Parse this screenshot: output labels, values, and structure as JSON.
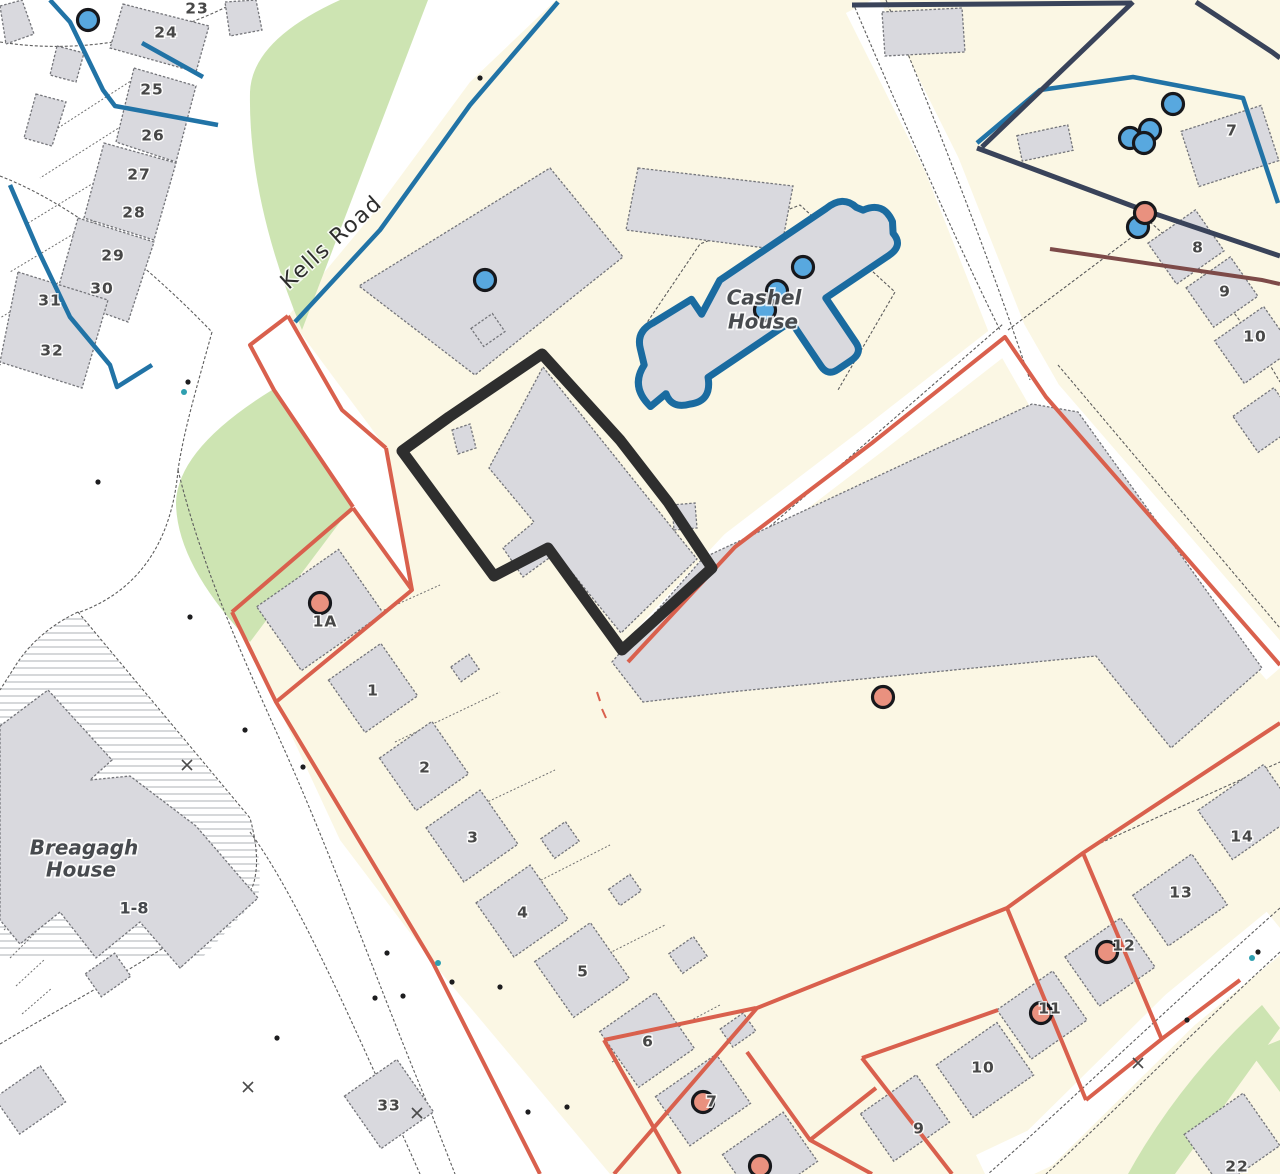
{
  "colors": {
    "plot_cream": "#fbf7e4",
    "building_gray": "#d9d9de",
    "green_area": "#cde4b2",
    "boundary_red": "#d9604d",
    "boundary_blue": "#2173a6",
    "boundary_navy": "#39435a",
    "cashel_blue": "#1a6ba0",
    "subject_outline": "#2e2e2e",
    "marker_blue": "#58a8df",
    "marker_orange": "#e9917f"
  },
  "road": {
    "name": "Kells Road"
  },
  "places": {
    "cashel_line1": "Cashel",
    "cashel_line2": "House",
    "breagagh_line1": "Breagagh",
    "breagagh_line2": "House",
    "breagagh_units": "1-8"
  },
  "plot_numbers": [
    {
      "t": "23",
      "x": 197,
      "y": 9
    },
    {
      "t": "24",
      "x": 166,
      "y": 33
    },
    {
      "t": "25",
      "x": 152,
      "y": 90
    },
    {
      "t": "26",
      "x": 153,
      "y": 136
    },
    {
      "t": "27",
      "x": 139,
      "y": 175
    },
    {
      "t": "28",
      "x": 134,
      "y": 213
    },
    {
      "t": "29",
      "x": 113,
      "y": 256
    },
    {
      "t": "30",
      "x": 102,
      "y": 289
    },
    {
      "t": "31",
      "x": 50,
      "y": 301
    },
    {
      "t": "32",
      "x": 52,
      "y": 351
    },
    {
      "t": "1A",
      "x": 325,
      "y": 622
    },
    {
      "t": "1",
      "x": 373,
      "y": 691
    },
    {
      "t": "2",
      "x": 425,
      "y": 768
    },
    {
      "t": "3",
      "x": 473,
      "y": 838
    },
    {
      "t": "4",
      "x": 523,
      "y": 913
    },
    {
      "t": "5",
      "x": 583,
      "y": 972
    },
    {
      "t": "6",
      "x": 648,
      "y": 1042
    },
    {
      "t": "7",
      "x": 712,
      "y": 1102
    },
    {
      "t": "33",
      "x": 389,
      "y": 1106
    },
    {
      "t": "7",
      "x": 1232,
      "y": 131
    },
    {
      "t": "8",
      "x": 1198,
      "y": 248
    },
    {
      "t": "9",
      "x": 1225,
      "y": 292
    },
    {
      "t": "10",
      "x": 1255,
      "y": 337
    },
    {
      "t": "14",
      "x": 1242,
      "y": 837
    },
    {
      "t": "13",
      "x": 1181,
      "y": 893
    },
    {
      "t": "12",
      "x": 1124,
      "y": 946
    },
    {
      "t": "11",
      "x": 1050,
      "y": 1009
    },
    {
      "t": "10",
      "x": 983,
      "y": 1068
    },
    {
      "t": "9",
      "x": 919,
      "y": 1129
    },
    {
      "t": "22",
      "x": 1237,
      "y": 1167
    }
  ],
  "markers": {
    "blue_dots": [
      {
        "x": 88,
        "y": 20
      },
      {
        "x": 485,
        "y": 280
      },
      {
        "x": 803,
        "y": 267
      },
      {
        "x": 777,
        "y": 291
      },
      {
        "x": 765,
        "y": 310
      },
      {
        "x": 1173,
        "y": 104
      },
      {
        "x": 1130,
        "y": 138
      },
      {
        "x": 1150,
        "y": 130
      },
      {
        "x": 1144,
        "y": 143
      },
      {
        "x": 1138,
        "y": 227
      }
    ],
    "orange_dots": [
      {
        "x": 1145,
        "y": 213
      },
      {
        "x": 883,
        "y": 697
      },
      {
        "x": 320,
        "y": 603
      },
      {
        "x": 703,
        "y": 1102
      },
      {
        "x": 760,
        "y": 1166
      },
      {
        "x": 1107,
        "y": 952
      },
      {
        "x": 1041,
        "y": 1013
      }
    ],
    "small_points": [
      {
        "x": 98,
        "y": 482
      },
      {
        "x": 188,
        "y": 382
      },
      {
        "x": 480,
        "y": 78
      },
      {
        "x": 190,
        "y": 617
      },
      {
        "x": 245,
        "y": 730
      },
      {
        "x": 303,
        "y": 767
      },
      {
        "x": 375,
        "y": 998
      },
      {
        "x": 403,
        "y": 996
      },
      {
        "x": 500,
        "y": 987
      },
      {
        "x": 387,
        "y": 953
      },
      {
        "x": 452,
        "y": 982
      },
      {
        "x": 277,
        "y": 1038
      },
      {
        "x": 528,
        "y": 1112
      },
      {
        "x": 567,
        "y": 1107
      },
      {
        "x": 1258,
        "y": 952
      },
      {
        "x": 1187,
        "y": 1020
      }
    ],
    "teal_points": [
      {
        "x": 438,
        "y": 963
      },
      {
        "x": 1252,
        "y": 958
      },
      {
        "x": 184,
        "y": 392
      }
    ],
    "crosses": [
      {
        "x": 187,
        "y": 765
      },
      {
        "x": 248,
        "y": 1087
      },
      {
        "x": 417,
        "y": 1113
      },
      {
        "x": 1138,
        "y": 1063
      }
    ]
  },
  "houses": [
    {
      "x": 320,
      "y": 610,
      "w": 100,
      "h": 78
    },
    {
      "x": 373,
      "y": 688,
      "w": 64,
      "h": 64
    },
    {
      "x": 424,
      "y": 766,
      "w": 64,
      "h": 64
    },
    {
      "x": 472,
      "y": 836,
      "w": 66,
      "h": 66
    },
    {
      "x": 522,
      "y": 911,
      "w": 66,
      "h": 66
    },
    {
      "x": 582,
      "y": 970,
      "w": 68,
      "h": 68
    },
    {
      "x": 647,
      "y": 1040,
      "w": 68,
      "h": 68
    },
    {
      "x": 703,
      "y": 1100,
      "w": 74,
      "h": 60
    },
    {
      "x": 770,
      "y": 1158,
      "w": 74,
      "h": 60
    },
    {
      "x": 389,
      "y": 1104,
      "w": 64,
      "h": 64
    },
    {
      "x": 108,
      "y": 975,
      "w": 36,
      "h": 28
    },
    {
      "x": 30,
      "y": 1100,
      "w": 56,
      "h": 44
    },
    {
      "x": 465,
      "y": 668,
      "w": 22,
      "h": 18
    },
    {
      "x": 560,
      "y": 840,
      "w": 30,
      "h": 24
    },
    {
      "x": 625,
      "y": 890,
      "w": 26,
      "h": 20
    },
    {
      "x": 688,
      "y": 955,
      "w": 30,
      "h": 24
    },
    {
      "x": 738,
      "y": 1030,
      "w": 28,
      "h": 22
    },
    {
      "x": 488,
      "y": 330,
      "w": 26,
      "h": 22
    },
    {
      "x": 1230,
      "y": 146,
      "w": 84,
      "h": 58,
      "rot": -18
    },
    {
      "x": 1045,
      "y": 143,
      "w": 52,
      "h": 26,
      "rot": -12
    },
    {
      "x": 1186,
      "y": 247,
      "w": 58,
      "h": 50
    },
    {
      "x": 1222,
      "y": 292,
      "w": 54,
      "h": 48
    },
    {
      "x": 1254,
      "y": 345,
      "w": 60,
      "h": 52
    },
    {
      "x": 1266,
      "y": 420,
      "w": 50,
      "h": 44
    },
    {
      "x": 1248,
      "y": 812,
      "w": 80,
      "h": 60
    },
    {
      "x": 1180,
      "y": 900,
      "w": 72,
      "h": 62
    },
    {
      "x": 1110,
      "y": 962,
      "w": 68,
      "h": 60
    },
    {
      "x": 1042,
      "y": 1015,
      "w": 68,
      "h": 60
    },
    {
      "x": 985,
      "y": 1070,
      "w": 74,
      "h": 64
    },
    {
      "x": 905,
      "y": 1118,
      "w": 68,
      "h": 58
    },
    {
      "x": 1232,
      "y": 1140,
      "w": 72,
      "h": 64
    }
  ]
}
